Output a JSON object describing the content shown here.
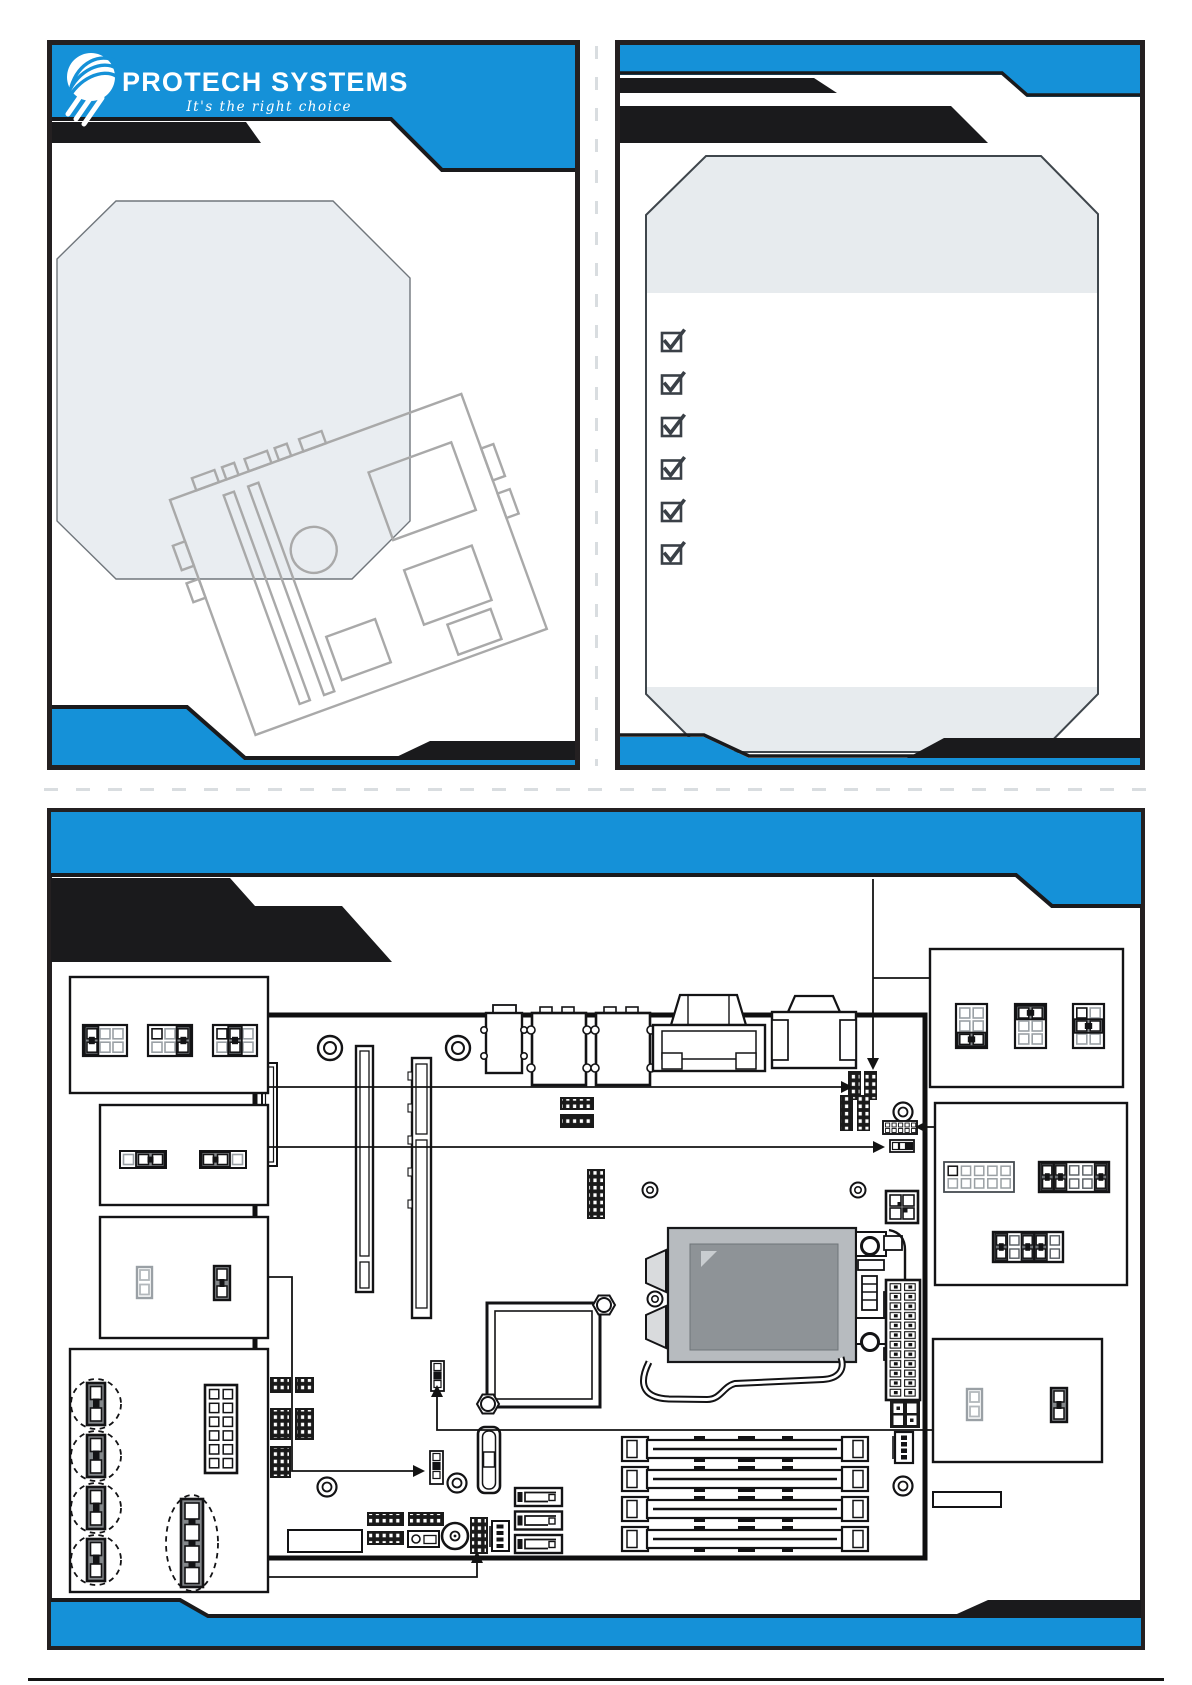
{
  "page": {
    "width": 1192,
    "height": 1685,
    "background": "#ffffff"
  },
  "brand": {
    "logo_text": "PROTECH SYSTEMS",
    "tagline": "It's  the  right  choice"
  },
  "colors": {
    "accent_blue": "#1591d8",
    "band_black": "#1a1a1c",
    "panel_border": "#242021",
    "placeholder_gray": "#e9edf1",
    "cpu_socket_outer": "#b7bbbf",
    "cpu_socket_inner": "#8e9397",
    "sketch_gray": "#a9a9a9",
    "checkbox_ink": "#3a4047",
    "dashed_fold_gray": "#d9dde0"
  },
  "front_cover_panel": {
    "elements": [
      "brand-logo",
      "photo-placeholder-octagon",
      "rotated-motherboard-sketch",
      "blue-footer-band"
    ]
  },
  "checklist_panel": {
    "checkboxes": [
      {
        "state": "checked"
      },
      {
        "state": "checked"
      },
      {
        "state": "checked"
      },
      {
        "state": "checked"
      },
      {
        "state": "checked"
      },
      {
        "state": "checked"
      }
    ]
  },
  "board_layout_panel": {
    "callout_boxes": [
      {
        "name": "jumper-settings-2x3",
        "jumpers": [
          {
            "pins": "2x3",
            "cap": "column-1"
          },
          {
            "pins": "2x3",
            "cap": "column-3"
          },
          {
            "pins": "2x3",
            "cap": "column-2"
          }
        ]
      },
      {
        "name": "jumper-settings-1x3",
        "jumpers": [
          {
            "pins": "1x3",
            "cap": "2-3"
          },
          {
            "pins": "1x3",
            "cap": "1-2"
          }
        ]
      },
      {
        "name": "jumper-settings-1x2",
        "jumpers": [
          {
            "pins": "1x2",
            "cap": "open"
          },
          {
            "pins": "1x2",
            "cap": "short"
          }
        ]
      },
      {
        "name": "front-panel-connector-group",
        "items": [
          "capped-jumper-circled",
          "capped-jumper-circled",
          "capped-jumper-circled",
          "capped-jumper-circled",
          "header-2x6",
          "capped-header-1x4-circled"
        ]
      },
      {
        "name": "jumper-settings-3x2",
        "jumpers": [
          {
            "pins": "3x2",
            "cap": "row-3"
          },
          {
            "pins": "3x2",
            "cap": "row-1"
          },
          {
            "pins": "3x2",
            "cap": "row-2"
          }
        ]
      },
      {
        "name": "header-settings-2x5",
        "headers": [
          {
            "pins": "2x5",
            "caps": "none"
          },
          {
            "pins": "2x5",
            "caps": "columns-1-2-5"
          },
          {
            "pins": "2x5",
            "caps": "columns-1-3-4"
          }
        ]
      },
      {
        "name": "jumper-settings-1x2-b",
        "jumpers": [
          {
            "pins": "1x2",
            "cap": "open"
          },
          {
            "pins": "1x2",
            "cap": "short"
          }
        ]
      }
    ],
    "motherboard_components": [
      "rear-audio-jack",
      "rear-usb-stack",
      "rear-usb-stack",
      "rear-vga-port",
      "rear-com-port",
      "pcie-x1-slot",
      "pci-slot",
      "pcie-x16-slot",
      "cpu-socket",
      "cpu-retention-lever",
      "heatsink-mount",
      "dimm-slot",
      "dimm-slot",
      "dimm-slot",
      "dimm-slot",
      "atx-24pin-power",
      "atx-4pin-power",
      "sata-port",
      "sata-port",
      "sata-port",
      "front-panel-header",
      "clear-cmos-jumper",
      "buzzer",
      "battery-holder",
      "mounting-hole"
    ]
  }
}
